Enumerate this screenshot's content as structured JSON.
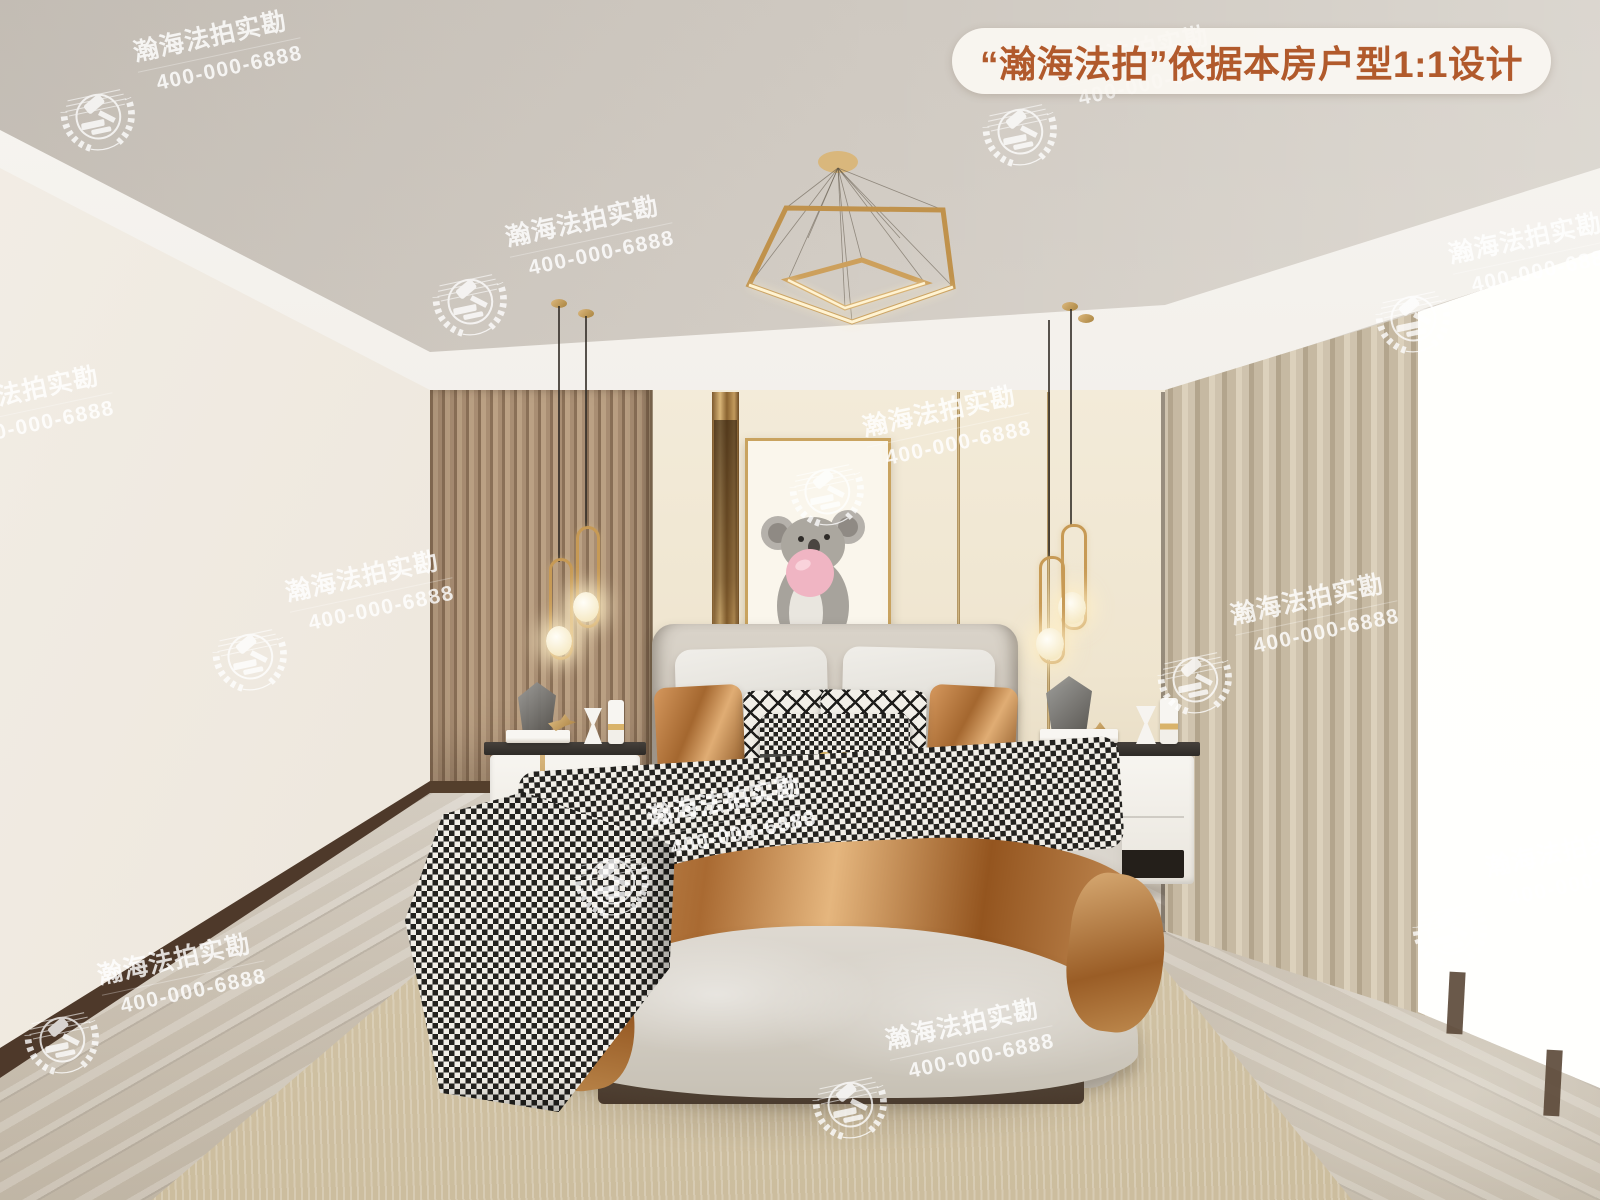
{
  "badge": {
    "text": "“瀚海法拍”依据本房户型1:1设计",
    "text_color": "#b15a2c",
    "bg_color": "#faf7f1"
  },
  "watermark": {
    "brand_text": "瀚海法拍实勘",
    "phone_text": "400-000-6888",
    "emblem": "gavel-in-laurel-wreath-icon",
    "color": "#ffffff",
    "rotation_deg": -12,
    "instances": [
      {
        "x": 98,
        "y": 115
      },
      {
        "x": 1020,
        "y": 130
      },
      {
        "x": 470,
        "y": 300
      },
      {
        "x": 1413,
        "y": 317
      },
      {
        "x": -90,
        "y": 470
      },
      {
        "x": 827,
        "y": 490
      },
      {
        "x": 250,
        "y": 655
      },
      {
        "x": 1195,
        "y": 678
      },
      {
        "x": 612,
        "y": 880
      },
      {
        "x": 62,
        "y": 1038
      },
      {
        "x": 850,
        "y": 1103
      },
      {
        "x": 1450,
        "y": 930
      }
    ]
  },
  "scene": {
    "description": "bedroom-interior-render",
    "artwork_subject": "koala-blowing-pink-bubblegum",
    "palette": {
      "ceiling": "#d5cfc7",
      "wall_cream": "#f1e8d4",
      "wood_slat": "#b1977d",
      "accent_gold": "#c79a55",
      "copper_satin": "#b4713a",
      "orange_pillow": "#b05a28",
      "curtain_linen": "#c6b9a2",
      "floor": "#d5cec4",
      "rug": "#d8cbae",
      "baseboard": "#4e392a",
      "bubble_pink": "#f0b5c3"
    }
  }
}
